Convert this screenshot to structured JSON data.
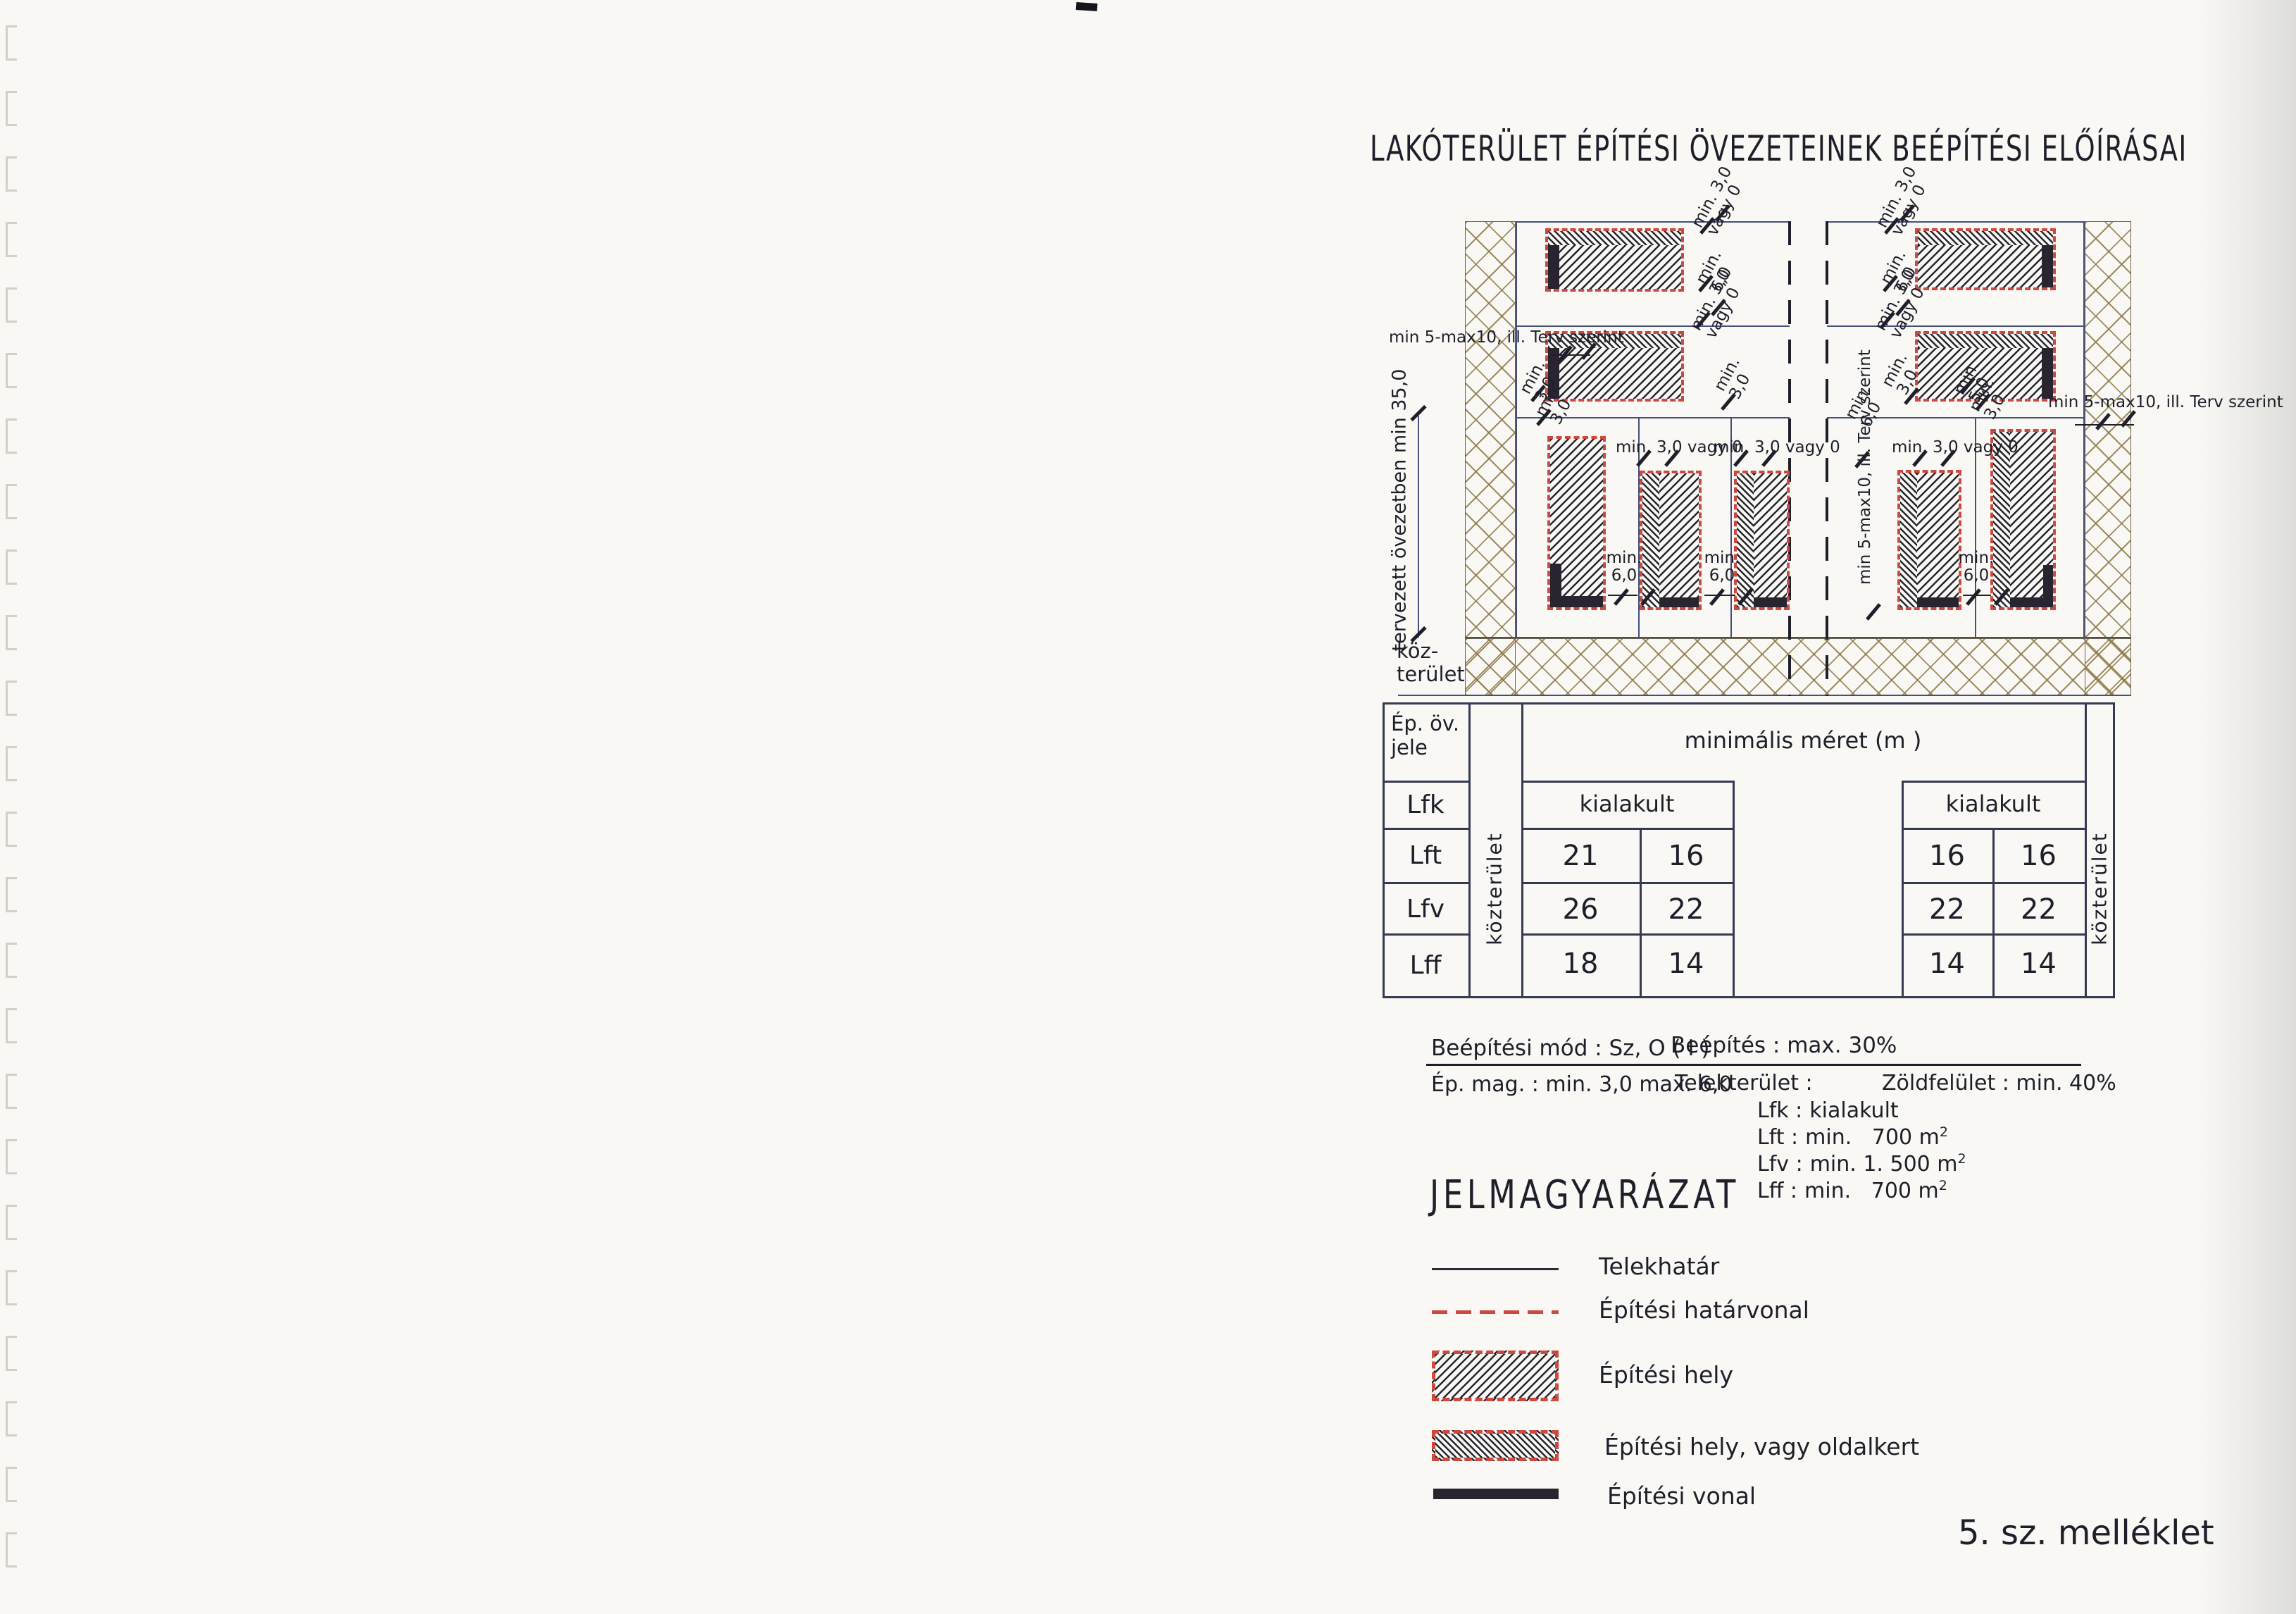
{
  "page": {
    "title": "LAKÓTERÜLET ÉPÍTÉSI ÖVEZETEINEK BEÉPÍTÉSI ELŐÍRÁSAI",
    "attachment": "5. sz. melléklet"
  },
  "colors": {
    "ink": "#1f1f2b",
    "red": "#cc4940",
    "hatch": "#262630",
    "lot_line": "#44507c",
    "table_line": "#343a52",
    "building_line": "#2a2431",
    "paper": "#f9f8f4"
  },
  "diagram": {
    "axis_label": "tervezett övezetben min 35,0",
    "public_area_line1": "köz-",
    "public_area_line2": "terület",
    "labels": {
      "min30": "min. 3,0",
      "vagy0": "vagy 0",
      "min": "min.",
      "v30": "3,0",
      "v50": "5,0",
      "v60": "6,0",
      "min30vagy0": "min. 3,0 vagy 0",
      "min5max": "min 5-max10, ill. Terv szerint"
    }
  },
  "table": {
    "col_header_1": "Ép. öv.",
    "col_header_2": "jele",
    "group_header": "minimális méret (m )",
    "sub_header": "kialakult",
    "side_label": "közterület",
    "rows": [
      {
        "label": "Lfk"
      },
      {
        "label": "Lft",
        "c": [
          "21",
          "16",
          "16",
          "16"
        ]
      },
      {
        "label": "Lfv",
        "c": [
          "26",
          "22",
          "22",
          "22"
        ]
      },
      {
        "label": "Lff",
        "c": [
          "18",
          "14",
          "14",
          "14"
        ]
      }
    ]
  },
  "specs": {
    "mode": "Beépítési mód : Sz, O ( I )",
    "coverage": "Beépítés : max. 30%",
    "height": "Ép. mag. : min. 3,0 max. 6,0",
    "plot": "Telekterület :",
    "green": "Zöldfelület : min. 40%",
    "items": [
      {
        "k": "Lfk :",
        "v": "kialakult",
        "s": ""
      },
      {
        "k": "Lft :",
        "v": "min.   700 m",
        "s": "2"
      },
      {
        "k": "Lfv :",
        "v": "min. 1. 500 m",
        "s": "2"
      },
      {
        "k": "Lff :",
        "v": "min.   700 m",
        "s": "2"
      }
    ]
  },
  "legend": {
    "heading": "JELMAGYARÁZAT",
    "items": [
      {
        "label": "Telekhatár"
      },
      {
        "label": "Építési határvonal"
      },
      {
        "label": "Építési hely"
      },
      {
        "label": "Építési hely, vagy oldalkert"
      },
      {
        "label": "Építési vonal"
      }
    ]
  }
}
